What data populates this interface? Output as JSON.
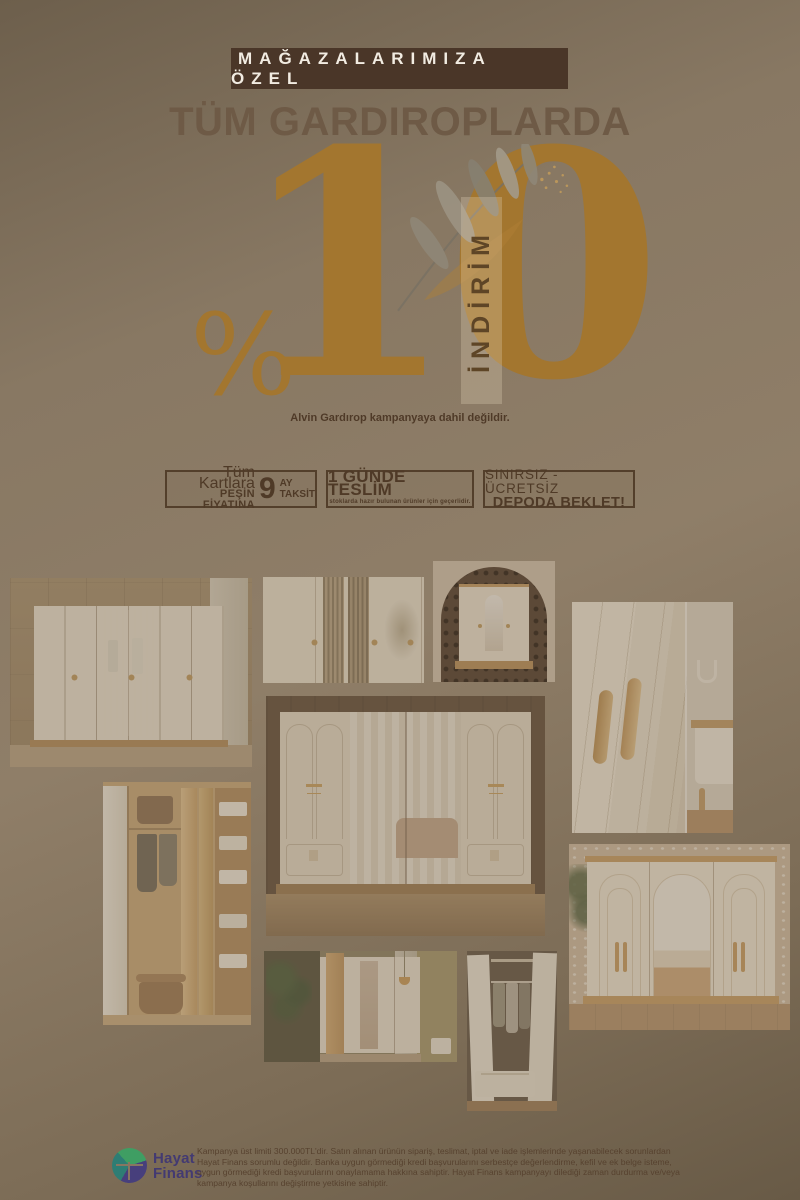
{
  "promo": {
    "store_badge": "MAĞAZALARIMIZA ÖZEL",
    "headline": "TÜM GARDIROPLARDA",
    "percent_sign": "%",
    "discount_value": "10",
    "discount_word": "İNDİRİM",
    "exclusion_note": "Alvin Gardırop kampanyaya dahil değildir.",
    "accent_color": "#a3762f",
    "badge_bg_color": "#4a3628",
    "text_color": "#4f3a27"
  },
  "offers": [
    {
      "line1": "Tüm Kartlara",
      "line2": "PEŞİN FİYATINA",
      "installment_count": "9",
      "unit1": "AY",
      "unit2": "TAKSİT"
    },
    {
      "title": "1 GÜNDE TESLİM",
      "note": "stoklarda hazır bulunan ürünler için geçerlidir."
    },
    {
      "line1": "SINIRSIZ - ÜCRETSİZ",
      "line2": "DEPODA BEKLET!"
    }
  ],
  "gallery": {
    "photos": [
      {
        "name": "white six-door wardrobe with arched panels and glass middle doors on wood wall"
      },
      {
        "name": "white wardrobe close-up with fluted glass doors"
      },
      {
        "name": "cream wardrobe with arch mirror inside dark perforated niche"
      },
      {
        "name": "close-up of cream doors with two wooden handles and bathroom corner"
      },
      {
        "name": "large cream wardrobe with double mirror doors reflecting bedroom"
      },
      {
        "name": "open wardrobe interior with clothes, shelves and linens"
      },
      {
        "name": "wood and white wardrobe with mirror, plant and pendant lamp"
      },
      {
        "name": "open white wardrobe with hanging clothes and drawer"
      },
      {
        "name": "cream arched wardrobe with wood handles on patterned wall"
      }
    ]
  },
  "footer": {
    "logo": {
      "line1": "Hayat",
      "line2": "Finans",
      "purple": "#473f7c",
      "green": "#3f9e63",
      "teal": "#2e7d74"
    },
    "legal": "Kampanya üst limiti 300.000TL'dir. Satın alınan ürünün sipariş, teslimat, iptal ve iade işlemlerinde yaşanabilecek sorunlardan Hayat Finans sorumlu değildir. Banka uygun görmediği kredi başvurularını serbestçe değerlendirme, kefil ve ek belge isteme, uygun görmediği kredi başvurularını onaylamama hakkına sahiptir. Hayat Finans kampanyayı dilediği zaman durdurma ve/veya kampanya koşullarını değiştirme yetkisine sahiptir."
  }
}
